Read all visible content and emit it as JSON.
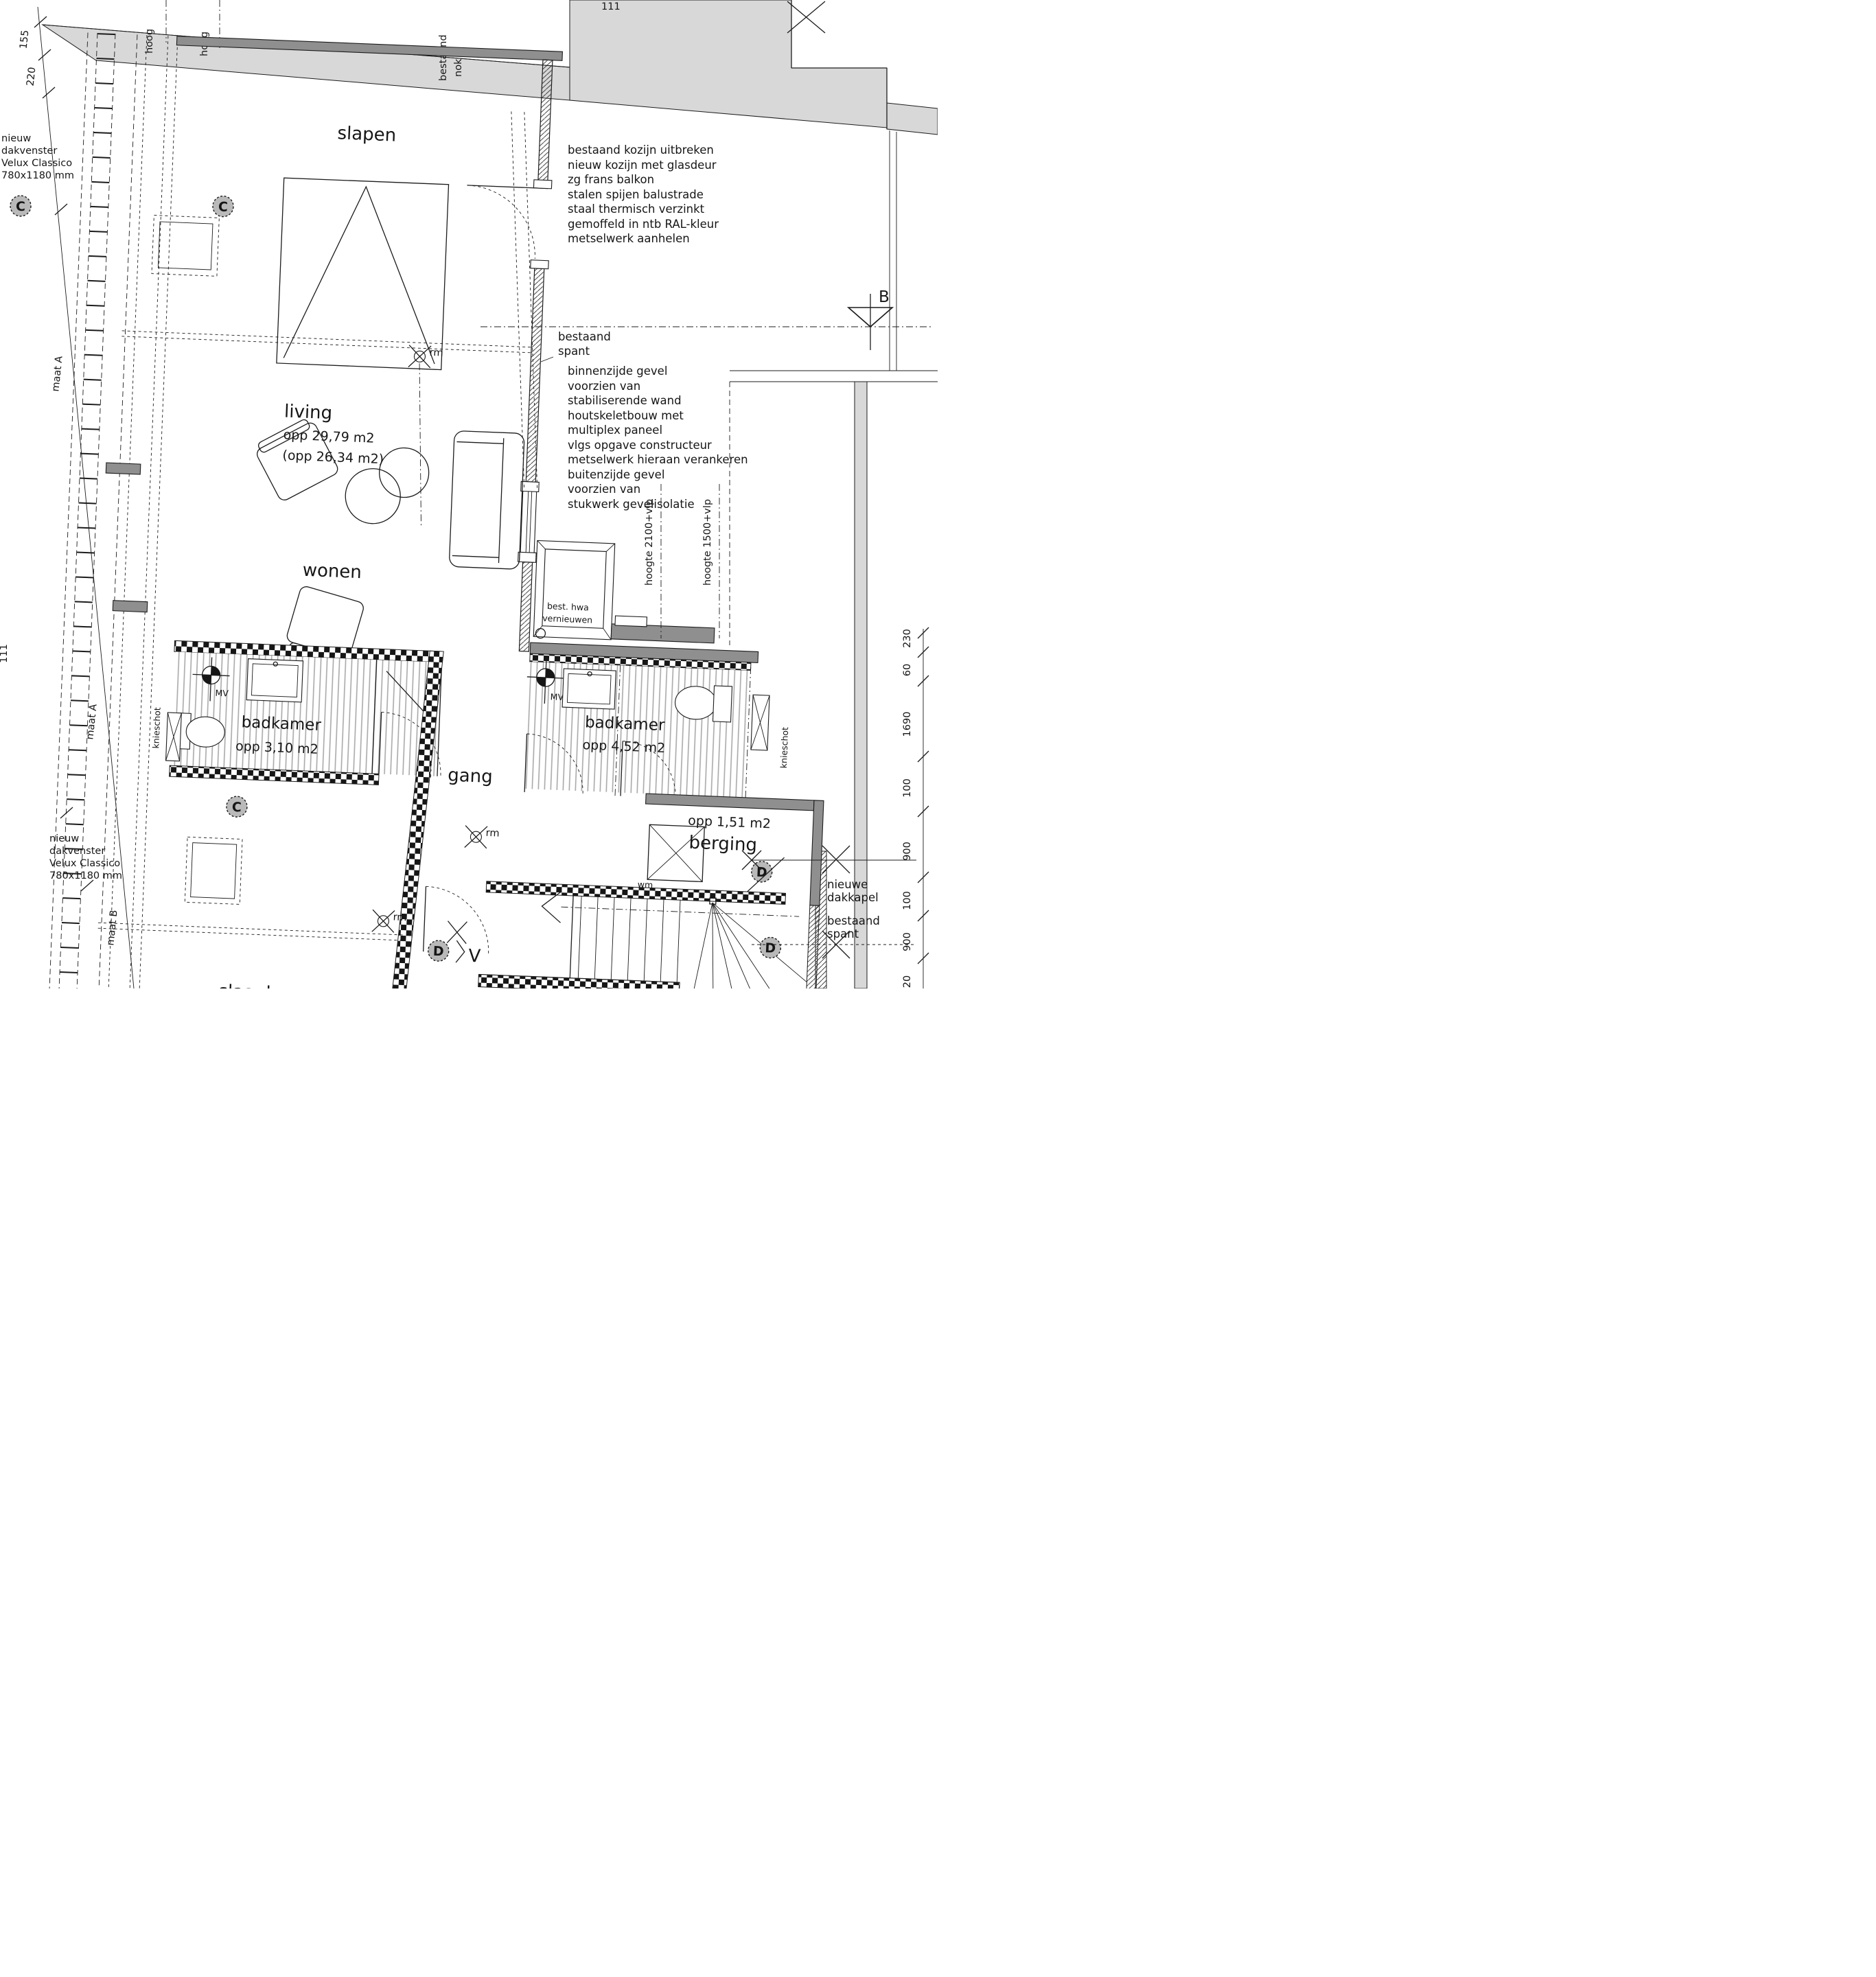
{
  "rooms": {
    "slapen": "slapen",
    "living": "living",
    "living_area": "opp 29,79 m2",
    "living_area2": "(opp 26,34 m2)",
    "wonen": "wonen",
    "gang": "gang",
    "badkamer1": "badkamer",
    "badkamer1_area": "opp 3,10 m2",
    "badkamer2": "badkamer",
    "badkamer2_area": "opp 4,52 m2",
    "berging": "berging",
    "berging_area": "opp 1,51 m2",
    "slaapkamer": "slaapkamer"
  },
  "notes": {
    "kozijn": [
      "bestaand kozijn uitbreken",
      "nieuw kozijn met glasdeur",
      "zg frans balkon",
      "stalen spijen balustrade",
      "staal thermisch verzinkt",
      "gemoffeld in ntb RAL-kleur",
      "metselwerk aanhelen"
    ],
    "gevel": [
      "binnenzijde gevel",
      "voorzien van",
      "stabiliserende wand",
      "houtskeletbouw met",
      "multiplex paneel",
      "vlgs opgave constructeur",
      "metselwerk hieraan verankeren",
      "buitenzijde gevel",
      "voorzien van",
      "stukwerk gevelisolatie"
    ],
    "spant": [
      "bestaand",
      "spant"
    ],
    "dakkapel": [
      "nieuwe",
      "dakkapel"
    ],
    "dakvenster": [
      "nieuw",
      "dakvenster",
      "Velux Classico",
      "780x1180 mm"
    ],
    "hwa": [
      "best. hwa",
      "vernieuwen"
    ],
    "nok": [
      "bestaand",
      "nok"
    ],
    "hoog": "hoog",
    "hoogte2100": "hoogte 2100+vlp",
    "hoogte1500": "hoogte 1500+vlp",
    "knieschot": "knieschot",
    "douche": "800x1200 mm"
  },
  "labels": {
    "mv": "MV",
    "rm": "rm",
    "wm": "wm",
    "v": "V"
  },
  "markers": {
    "b": "B",
    "c": "C",
    "d": "D"
  },
  "dims": {
    "d220": "220",
    "d155": "155",
    "maatA": "maat A",
    "maatB": "maat B",
    "d230": "230",
    "d60": "60",
    "d1690": "1690",
    "d100": "100",
    "d900": "900",
    "d20": "20",
    "d111": "111"
  }
}
